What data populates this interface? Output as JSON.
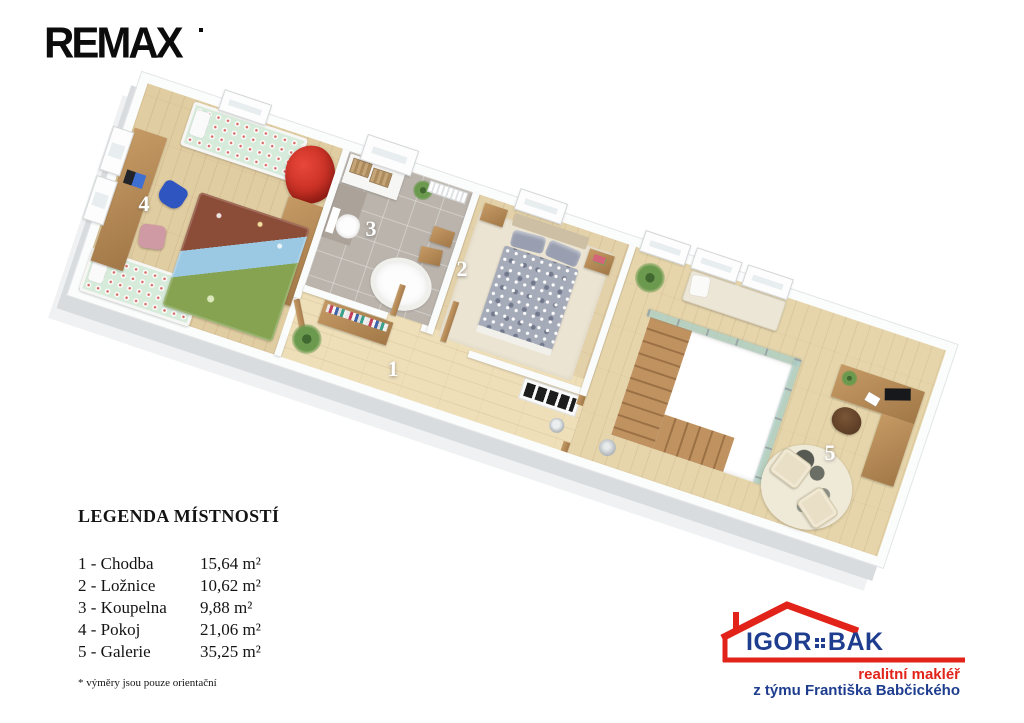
{
  "header": {
    "brand": "REMAX"
  },
  "plan": {
    "rooms": [
      {
        "number": "1",
        "name": "Chodba"
      },
      {
        "number": "2",
        "name": "Ložnice"
      },
      {
        "number": "3",
        "name": "Koupelna"
      },
      {
        "number": "4",
        "name": "Pokoj"
      },
      {
        "number": "5",
        "name": "Galerie"
      }
    ]
  },
  "legend": {
    "title": "LEGENDA MÍSTNOSTÍ",
    "rows": [
      {
        "label": "1 - Chodba",
        "area": "15,64 m²"
      },
      {
        "label": "2 - Ložnice",
        "area": "10,62 m²"
      },
      {
        "label": "3 - Koupelna",
        "area": "9,88 m²"
      },
      {
        "label": "4 - Pokoj",
        "area": "21,06 m²"
      },
      {
        "label": "5 - Galerie",
        "area": "35,25 m²"
      }
    ],
    "footnote": "* výměry jsou pouze orientační"
  },
  "agent": {
    "name_left": "IGOR",
    "name_right": "BAK",
    "tagline1": "realitní makléř",
    "tagline2": "z týmu Františka Babčického",
    "colors": {
      "red": "#e2231a",
      "blue": "#1e3d8f"
    }
  }
}
